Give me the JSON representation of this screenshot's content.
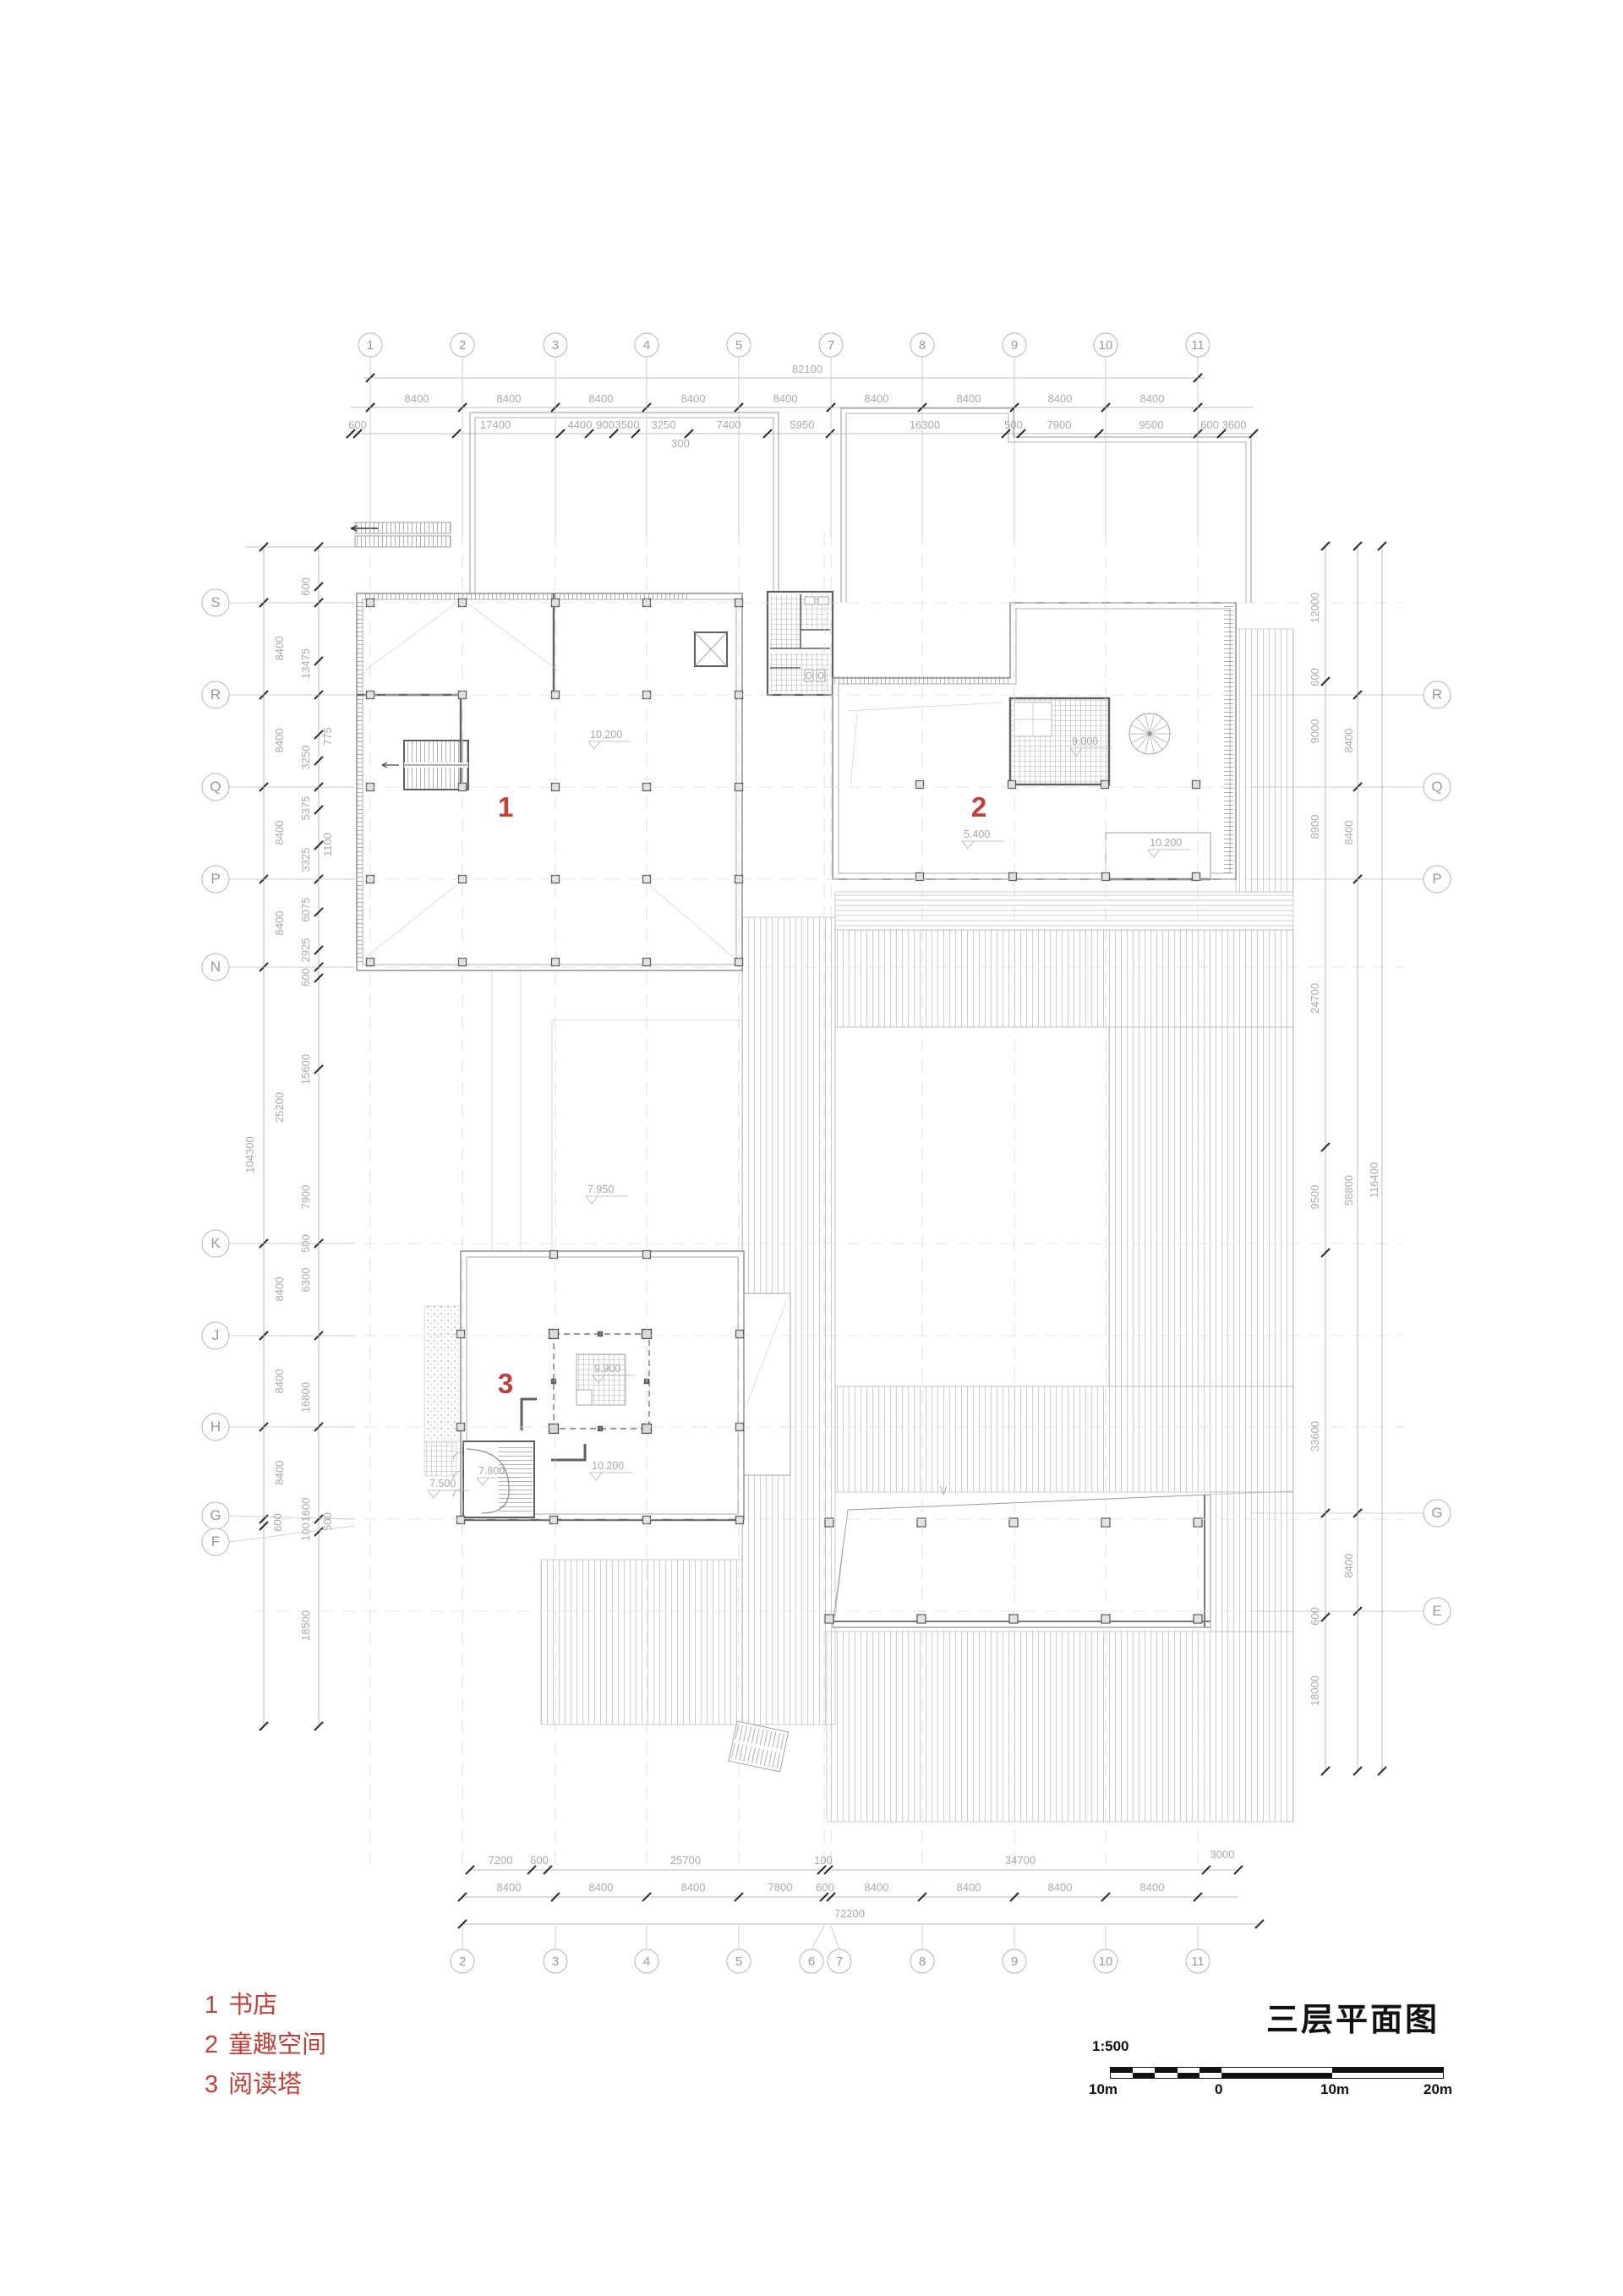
{
  "drawing": {
    "title": "三层平面图",
    "scale_label": "1:500",
    "scalebar_labels": [
      "10m",
      "0",
      "10m",
      "20m"
    ]
  },
  "legend": {
    "items": [
      {
        "num": "1",
        "name": "书店"
      },
      {
        "num": "2",
        "name": "童趣空间"
      },
      {
        "num": "3",
        "name": "阅读塔"
      }
    ]
  },
  "room_labels": [
    "1",
    "2",
    "3"
  ],
  "grid": {
    "top": [
      "1",
      "2",
      "3",
      "4",
      "5",
      "7",
      "8",
      "9",
      "10",
      "11"
    ],
    "bottom": [
      "2",
      "3",
      "4",
      "5",
      "6",
      "7",
      "8",
      "9",
      "10",
      "11"
    ],
    "left": [
      "S",
      "R",
      "Q",
      "P",
      "N",
      "K",
      "J",
      "H",
      "G",
      "F"
    ],
    "right": [
      "R",
      "Q",
      "P",
      "G",
      "E"
    ]
  },
  "dims": {
    "top_total": "82100",
    "top_bays": [
      "8400",
      "8400",
      "8400",
      "8400",
      "8400",
      "8400",
      "8400",
      "8400",
      "8400"
    ],
    "top_sub": [
      "600",
      "17400",
      "4400",
      "900",
      "3500",
      "3250",
      "7400",
      "5950",
      "16300",
      "500",
      "7900",
      "9500",
      "600",
      "3600",
      "300"
    ],
    "bottom_sub": [
      "7200",
      "600",
      "25700",
      "100",
      "34700",
      "3000"
    ],
    "bottom_bays": [
      "8400",
      "8400",
      "8400",
      "7800",
      "600",
      "8400",
      "8400",
      "8400",
      "8400"
    ],
    "bottom_total": "72200",
    "left": [
      "8400",
      "8400",
      "8400",
      "8400",
      "25200",
      "8400",
      "8400",
      "8400",
      "600",
      "104300",
      "600",
      "13475",
      "3250",
      "5375",
      "3325",
      "6075",
      "2925",
      "600",
      "15600",
      "7900",
      "500",
      "6300",
      "16800",
      "1600",
      "100",
      "18500",
      "775",
      "1100",
      "500"
    ],
    "right": [
      "12000",
      "600",
      "9000",
      "8900",
      "24700",
      "9500",
      "33600",
      "600",
      "18000",
      "8400",
      "8400",
      "58800",
      "8400",
      "116400"
    ]
  },
  "elevations": [
    "10.200",
    "9.000",
    "5.400",
    "10.200",
    "7.950",
    "9.900",
    "10.200",
    "7.800",
    "7.500"
  ],
  "colors": {
    "accent_red": "#c0413c",
    "line_gray": "#9b9b9b"
  }
}
